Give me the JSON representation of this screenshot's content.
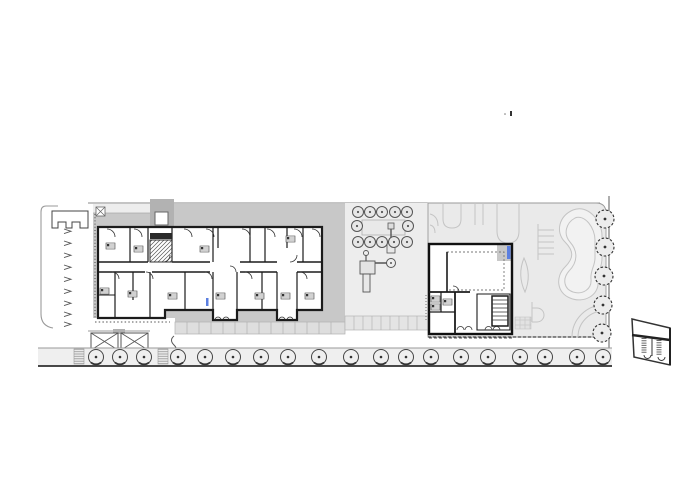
{
  "document": {
    "type": "architectural-site-plan",
    "view": "ground-floor site plan with two building blocks, courtyard, skatepark and street trees",
    "visible_text": []
  },
  "palette": {
    "background": "#ffffff",
    "wall": "#1b1b1b",
    "deck_gray": "#c8c8c8",
    "porch_gray": "#b2b2b2",
    "courtyard_gray": "#ededed",
    "skatepark_gray": "#eaeaea",
    "contour_gray": "#c4c4c4",
    "street_gray": "#efefef",
    "tile_gray": "#dedede",
    "accent_blue": "#5b7fe0",
    "line_light": "#999999",
    "line_dark": "#2f2f2f"
  },
  "symbols": {
    "street_trees": {
      "icon": "tree-icon",
      "y": 357,
      "r": 7.5,
      "x": [
        96,
        120,
        144,
        178,
        205,
        233,
        261,
        288,
        319,
        351,
        381,
        406,
        431,
        461,
        488,
        520,
        545,
        577,
        603
      ]
    },
    "street_ramps": {
      "icon": "ramp-hatch-icon",
      "y": 349,
      "w": 10,
      "h": 15,
      "x": [
        74,
        158
      ]
    },
    "courtyard_trees": {
      "icon": "tree-icon",
      "r": 5.5,
      "rows": [
        {
          "y": 212,
          "x": [
            358,
            370,
            382,
            395,
            407
          ]
        },
        {
          "y": 226,
          "x": [
            357,
            408
          ]
        },
        {
          "y": 242,
          "x": [
            358,
            370,
            382,
            394,
            407
          ]
        }
      ]
    },
    "boundary_trees": {
      "icon": "tree-icon",
      "r": 9,
      "points": [
        [
          605,
          219
        ],
        [
          605,
          247
        ],
        [
          604,
          276
        ],
        [
          603,
          305
        ],
        [
          602,
          333
        ]
      ]
    },
    "parking_arrows": {
      "icon": "arrow-icon",
      "x": 64,
      "y": [
        229,
        241,
        253,
        265,
        277,
        289,
        301,
        312,
        322
      ]
    },
    "unit_fixtures": {
      "icon": "kitchen-fixture-icon",
      "points": [
        [
          106,
          243
        ],
        [
          134,
          246
        ],
        [
          200,
          246
        ],
        [
          286,
          236
        ],
        [
          100,
          288
        ],
        [
          128,
          291
        ],
        [
          168,
          293
        ],
        [
          216,
          293
        ],
        [
          255,
          293
        ],
        [
          281,
          293
        ],
        [
          305,
          293
        ],
        [
          431,
          296
        ],
        [
          431,
          304
        ],
        [
          443,
          299
        ]
      ]
    },
    "top_door_arcs": {
      "icon": "door-arc-icon",
      "x": [
        107,
        134,
        184,
        206,
        242,
        267,
        294,
        312
      ]
    },
    "lower_door_arcs": {
      "icon": "door-arc-icon",
      "x": [
        112,
        146,
        205,
        245,
        300
      ]
    }
  }
}
